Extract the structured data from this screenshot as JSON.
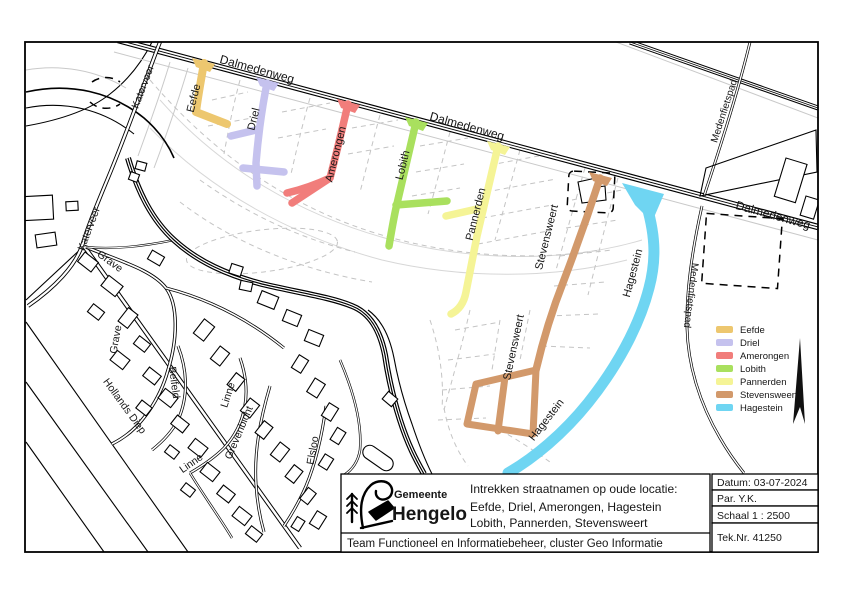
{
  "map": {
    "street_names": {
      "dalmedenweg": "Dalmedenweg",
      "katerveer": "Katerveer",
      "medenfietspad": "Medenfietspad",
      "eefde": "Eefde",
      "driel": "Driel",
      "amerongen": "Amerongen",
      "lobith": "Lobith",
      "pannerden": "Pannerden",
      "stevensweert": "Stevensweert",
      "hagestein": "Hagestein",
      "grave": "Grave",
      "hollands_diep": "Hollands Diep",
      "belfeld": "Belfeld",
      "linne": "Linne",
      "grevenbicht": "Grevenbicht",
      "elsloo": "Elsloo"
    }
  },
  "legend": {
    "items": [
      {
        "label": "Eefde",
        "color": "#edc76f"
      },
      {
        "label": "Driel",
        "color": "#c5c2ee"
      },
      {
        "label": "Amerongen",
        "color": "#f17d7b"
      },
      {
        "label": "Lobith",
        "color": "#a9e05e"
      },
      {
        "label": "Pannerden",
        "color": "#f5f496"
      },
      {
        "label": "Stevensweert",
        "color": "#d2996b"
      },
      {
        "label": "Hagestein",
        "color": "#6fd5f2"
      }
    ]
  },
  "title_block": {
    "logo_top": "Gemeente",
    "logo_bottom": "Hengelo",
    "title": "Intrekken straatnamen op oude locatie:",
    "subtitle_line1": "Eefde, Driel, Amerongen, Hagestein",
    "subtitle_line2": "Lobith, Pannerden, Stevensweert",
    "footer": "Team Functioneel en Informatiebeheer, cluster Geo Informatie",
    "datum": "Datum: 03-07-2024",
    "paraaf": "Par. Y.K.",
    "schaal": "Schaal  1 : 2500",
    "tekeningnummer": "Tek.Nr. 41250"
  }
}
